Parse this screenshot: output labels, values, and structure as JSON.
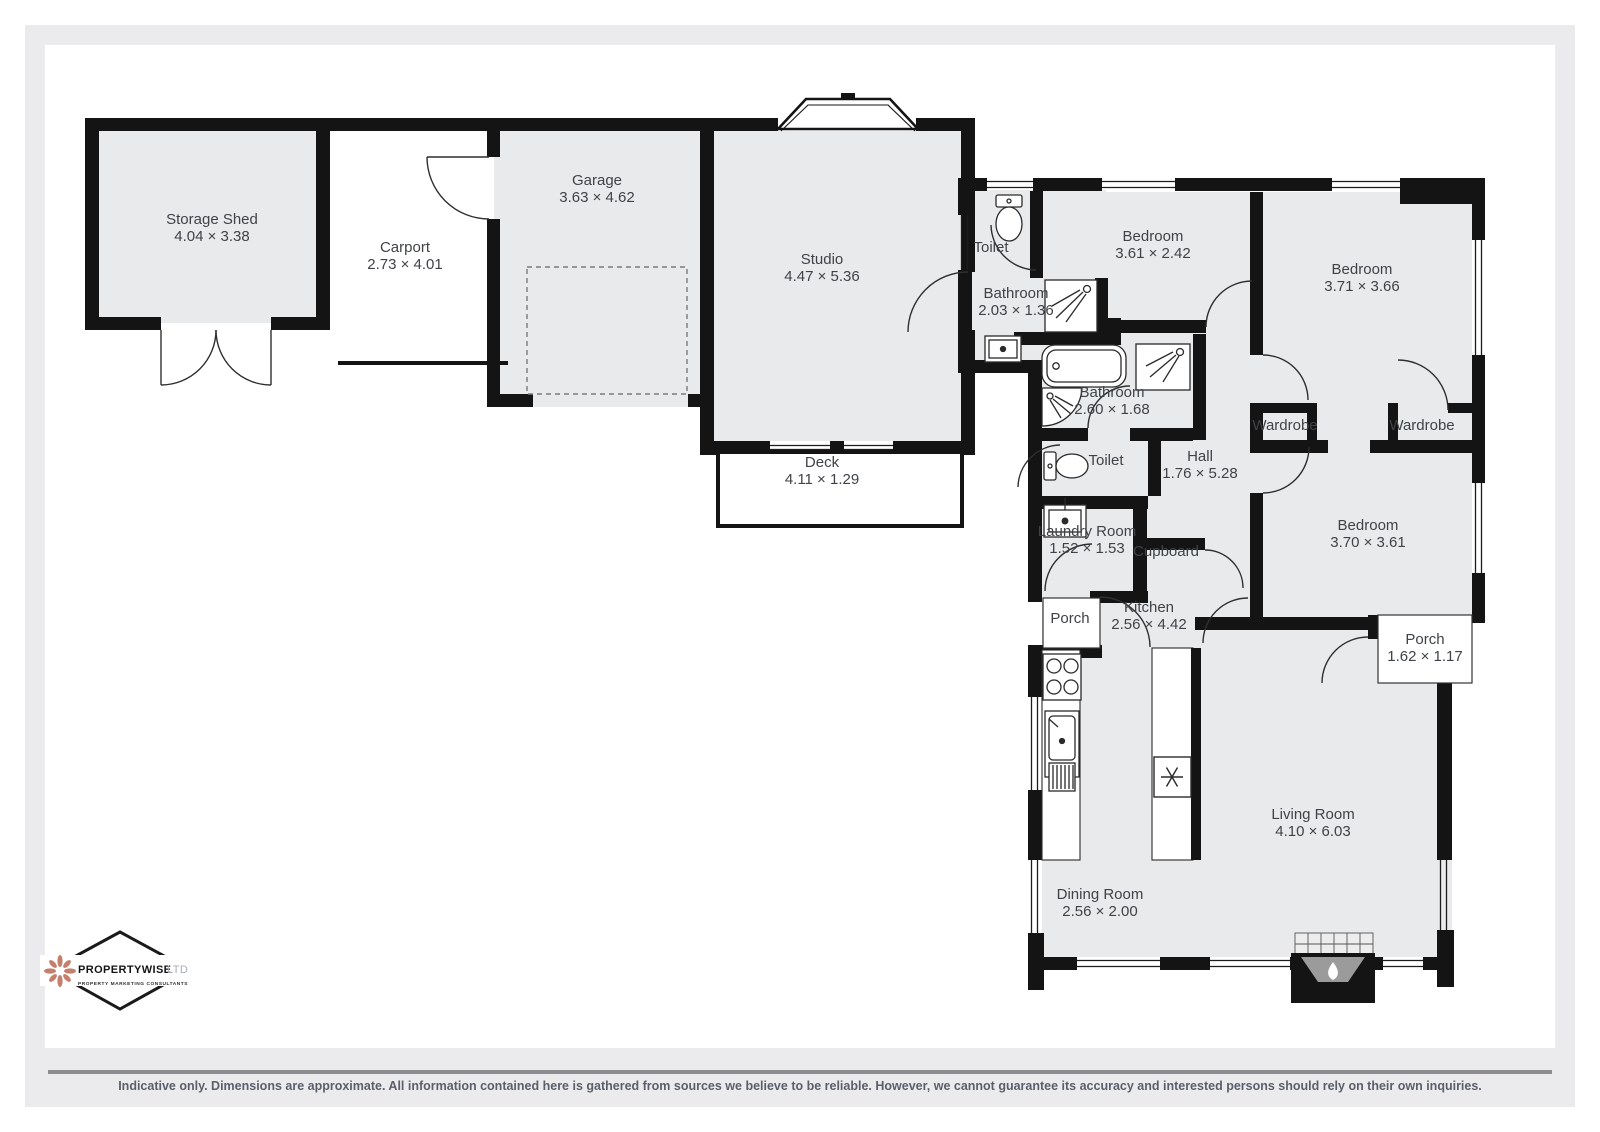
{
  "floorplan": {
    "rooms": [
      {
        "name": "Storage Shed",
        "dims": "4.04 × 3.38"
      },
      {
        "name": "Carport",
        "dims": "2.73 × 4.01"
      },
      {
        "name": "Garage",
        "dims": "3.63 × 4.62"
      },
      {
        "name": "Studio",
        "dims": "4.47 × 5.36"
      },
      {
        "name": "Deck",
        "dims": "4.11 × 1.29"
      },
      {
        "name": "Toilet",
        "dims": ""
      },
      {
        "name": "Bathroom",
        "dims": "2.03 × 1.36"
      },
      {
        "name": "Bedroom",
        "dims": "3.61 × 2.42"
      },
      {
        "name": "Bedroom",
        "dims": "3.71 × 3.66"
      },
      {
        "name": "Bathroom",
        "dims": "2.60 × 1.68"
      },
      {
        "name": "Toilet",
        "dims": ""
      },
      {
        "name": "Hall",
        "dims": "1.76 × 5.28"
      },
      {
        "name": "Wardrobe",
        "dims": ""
      },
      {
        "name": "Wardrobe",
        "dims": ""
      },
      {
        "name": "Bedroom",
        "dims": "3.70 × 3.61"
      },
      {
        "name": "Laundry Room",
        "dims": "1.52 × 1.53"
      },
      {
        "name": "Cupboard",
        "dims": ""
      },
      {
        "name": "Porch",
        "dims": ""
      },
      {
        "name": "Kitchen",
        "dims": "2.56 × 4.42"
      },
      {
        "name": "Porch",
        "dims": "1.62 × 1.17"
      },
      {
        "name": "Living Room",
        "dims": "4.10 × 6.03"
      },
      {
        "name": "Dining Room",
        "dims": "2.56 × 2.00"
      }
    ],
    "colors": {
      "wall": "#141414",
      "room_fill": "#e9eaec",
      "logo_flower": "#c5806d",
      "footer_text": "#5a5f6b"
    },
    "icons": {
      "logo-flower-icon": "8-petal flower",
      "fridge-snowflake-icon": "snowflake spokes",
      "fireplace-flame-icon": "white flame drop",
      "toilet-icon": "tank + bowl",
      "shower-icon": "square with sprayer",
      "bathtub-icon": "rounded tub",
      "sink-icon": "basin with tap dot",
      "stove-icon": "four burners"
    }
  },
  "logo": {
    "name": "PROPERTYWISE",
    "suffix": "LTD",
    "tagline": "PROPERTY MARKETING CONSULTANTS"
  },
  "footer": {
    "disclaimer": "Indicative only. Dimensions are approximate. All information contained here is gathered from sources we believe to be reliable. However, we cannot guarantee its accuracy and interested persons should rely on their own inquiries."
  }
}
